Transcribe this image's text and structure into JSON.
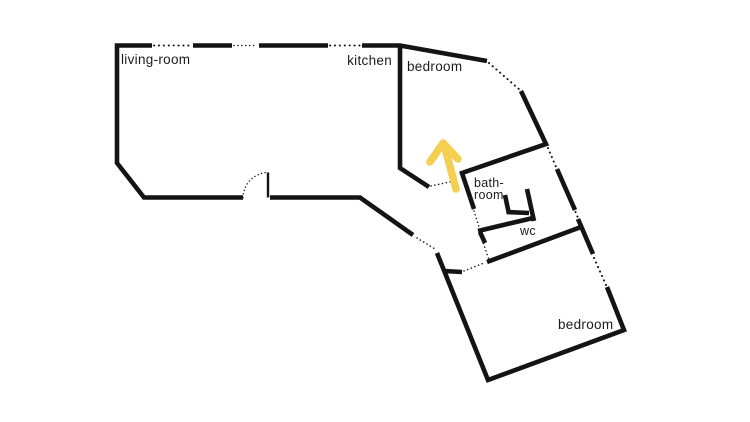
{
  "figure": {
    "type": "floor-plan",
    "background": "#ffffff"
  },
  "colors": {
    "wall": "#141414",
    "text": "#1c1c1c",
    "arrow": "#F5CF4F"
  },
  "rooms": {
    "living_room": {
      "label": "living-room"
    },
    "kitchen": {
      "label": "kitchen"
    },
    "bedroom_top": {
      "label": "bedroom"
    },
    "bathroom": {
      "label_line1": "bath-",
      "label_line2": "room"
    },
    "wc": {
      "label": "wc"
    },
    "bedroom_bottom": {
      "label": "bedroom"
    }
  },
  "annotations": {
    "arrow": {
      "direction": "up",
      "color": "#F5CF4F"
    }
  }
}
